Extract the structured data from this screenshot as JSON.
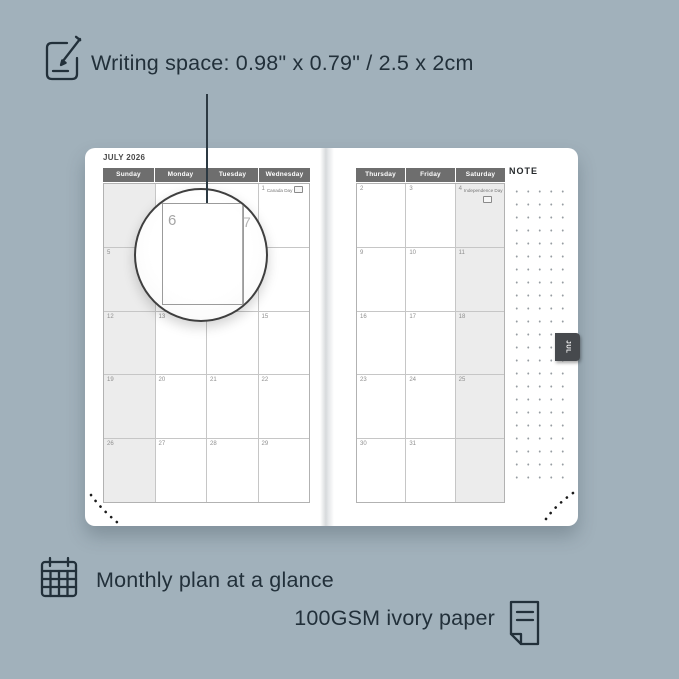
{
  "features": {
    "writing_space": "Writing space: 0.98\" x 0.79\" / 2.5 x 2cm",
    "monthly_plan": "Monthly plan at a glance",
    "paper": "100GSM ivory paper"
  },
  "icons": {
    "writing_space": "pencil-note-icon",
    "monthly_plan": "calendar-grid-icon",
    "paper": "paper-sheet-icon"
  },
  "planner": {
    "month_title": "JULY 2026",
    "tab_label": "JUL",
    "note_label": "NOTE",
    "left": {
      "day_headers": [
        "Sunday",
        "Monday",
        "Tuesday",
        "Wednesday"
      ],
      "holiday": {
        "date": "1",
        "label": "Canada Day"
      },
      "rows": [
        [
          "",
          "",
          "",
          ""
        ],
        [
          "5",
          "",
          "",
          ""
        ],
        [
          "12",
          "13",
          "",
          "15"
        ],
        [
          "19",
          "20",
          "21",
          "22"
        ],
        [
          "26",
          "27",
          "28",
          "29"
        ]
      ]
    },
    "right": {
      "day_headers": [
        "Thursday",
        "Friday",
        "Saturday"
      ],
      "holiday": {
        "date": "4",
        "label": "Independence Day"
      },
      "rows": [
        [
          "2",
          "3",
          ""
        ],
        [
          "9",
          "10",
          "11"
        ],
        [
          "16",
          "17",
          "18"
        ],
        [
          "23",
          "24",
          "25"
        ],
        [
          "30",
          "31",
          ""
        ]
      ]
    }
  },
  "magnifier": {
    "day": "6",
    "next_day": "7"
  },
  "colors": {
    "background": "#a1b1bb",
    "page": "#ffffff",
    "header_bar": "#6e6e6e",
    "weekend_shade": "#ececec",
    "tab": "#46494d",
    "text_dark": "#22303a",
    "date_gray": "#8f8f8f"
  }
}
